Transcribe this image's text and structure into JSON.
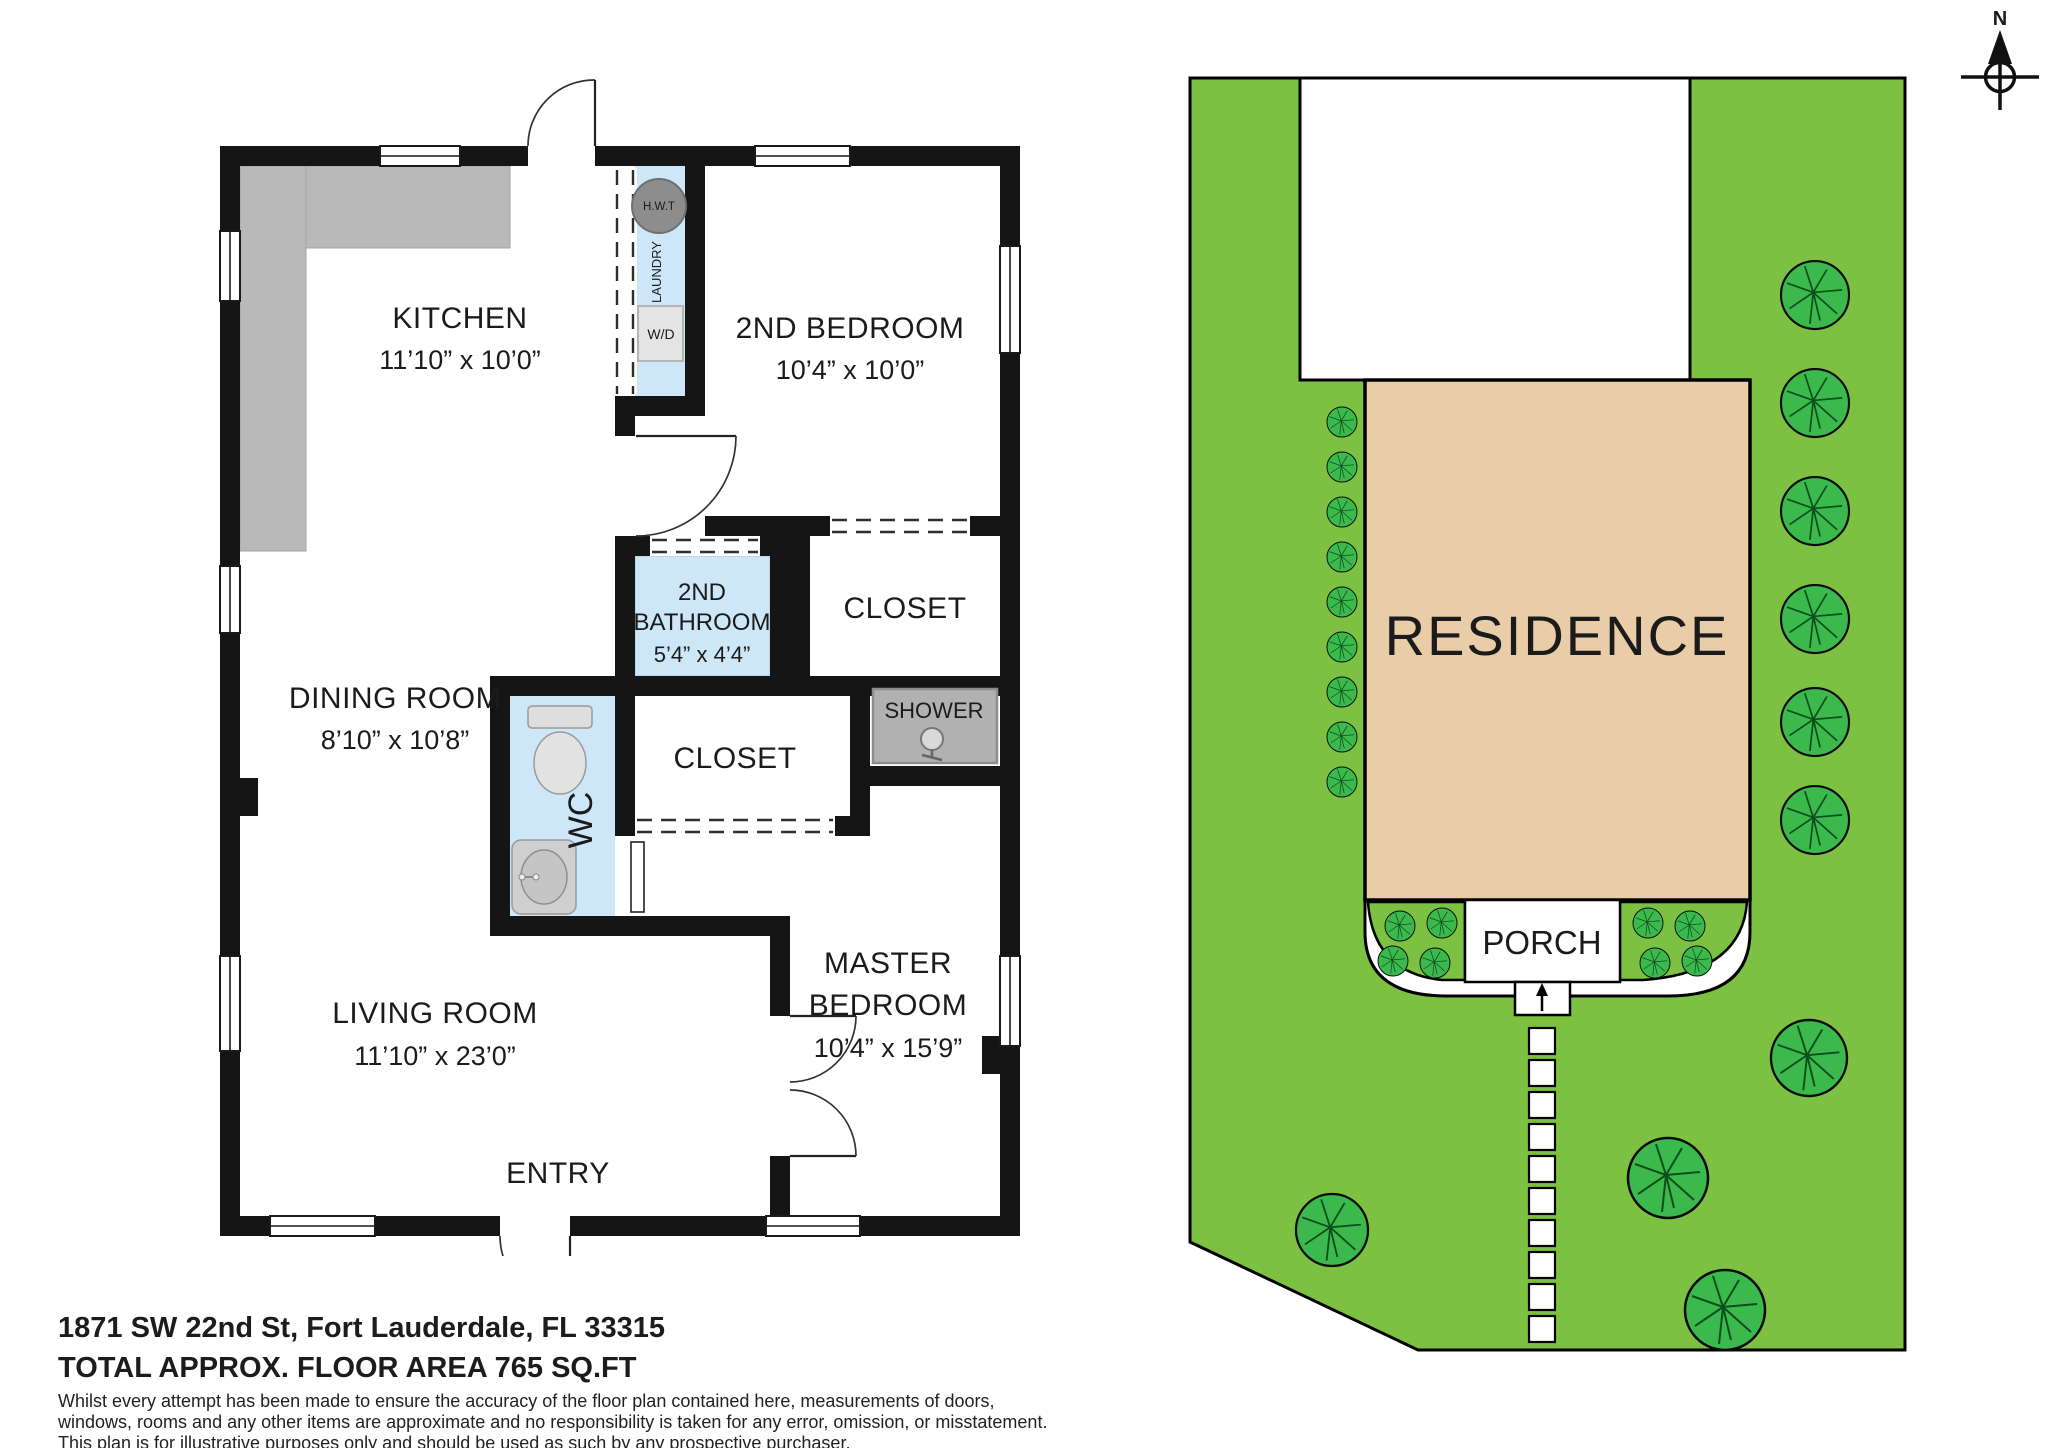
{
  "floor_plan": {
    "rooms": {
      "kitchen": {
        "name": "KITCHEN",
        "dims": "11’10” x 10’0”"
      },
      "second_bedroom": {
        "name": "2ND BEDROOM",
        "dims": "10’4” x 10’0”"
      },
      "dining_room": {
        "name": "DINING ROOM",
        "dims": "8’10” x 10’8”"
      },
      "second_bathroom": {
        "line1": "2ND",
        "line2": "BATHROOM",
        "dims": "5’4” x 4’4”"
      },
      "living_room": {
        "name": "LIVING ROOM",
        "dims": "11’10” x 23’0”"
      },
      "master_bedroom": {
        "line1": "MASTER",
        "line2": "BEDROOM",
        "dims": "10’4” x 15’9”"
      },
      "closet_bedroom2": {
        "name": "CLOSET"
      },
      "closet_master": {
        "name": "CLOSET"
      },
      "wc": {
        "name": "WC"
      },
      "entry": {
        "name": "ENTRY"
      }
    },
    "fixtures": {
      "shower": {
        "name": "SHOWER"
      },
      "laundry": {
        "name": "LAUNDRY"
      },
      "water_heater": {
        "name": "H.W.T"
      },
      "washer_dryer": {
        "name": "W/D"
      }
    },
    "colors": {
      "wall": "#151515",
      "wet_room_fill": "#cde7f8",
      "counter_gray": "#b9b9b9",
      "shower_gray": "#b1b1b1",
      "hwt_gray": "#8d8d8d"
    }
  },
  "site_plan": {
    "residence_label": "RESIDENCE",
    "porch_label": "PORCH",
    "colors": {
      "lawn": "#7cc142",
      "foliage": "#3cb94d",
      "residence_fill": "#e9cda9"
    }
  },
  "compass": {
    "north_label": "N"
  },
  "footer": {
    "address": "1871 SW 22nd St, Fort Lauderdale, FL 33315",
    "floor_area": "TOTAL APPROX. FLOOR AREA 765 SQ.FT",
    "disclaimer_lines": [
      "Whilst every attempt has been made to ensure the accuracy of the floor plan contained here, measurements of doors,",
      "windows, rooms and any other items are approximate and no responsibility is taken for any error, omission, or misstatement.",
      "This plan is for illustrative purposes only and should be used as such by any prospective purchaser."
    ]
  }
}
